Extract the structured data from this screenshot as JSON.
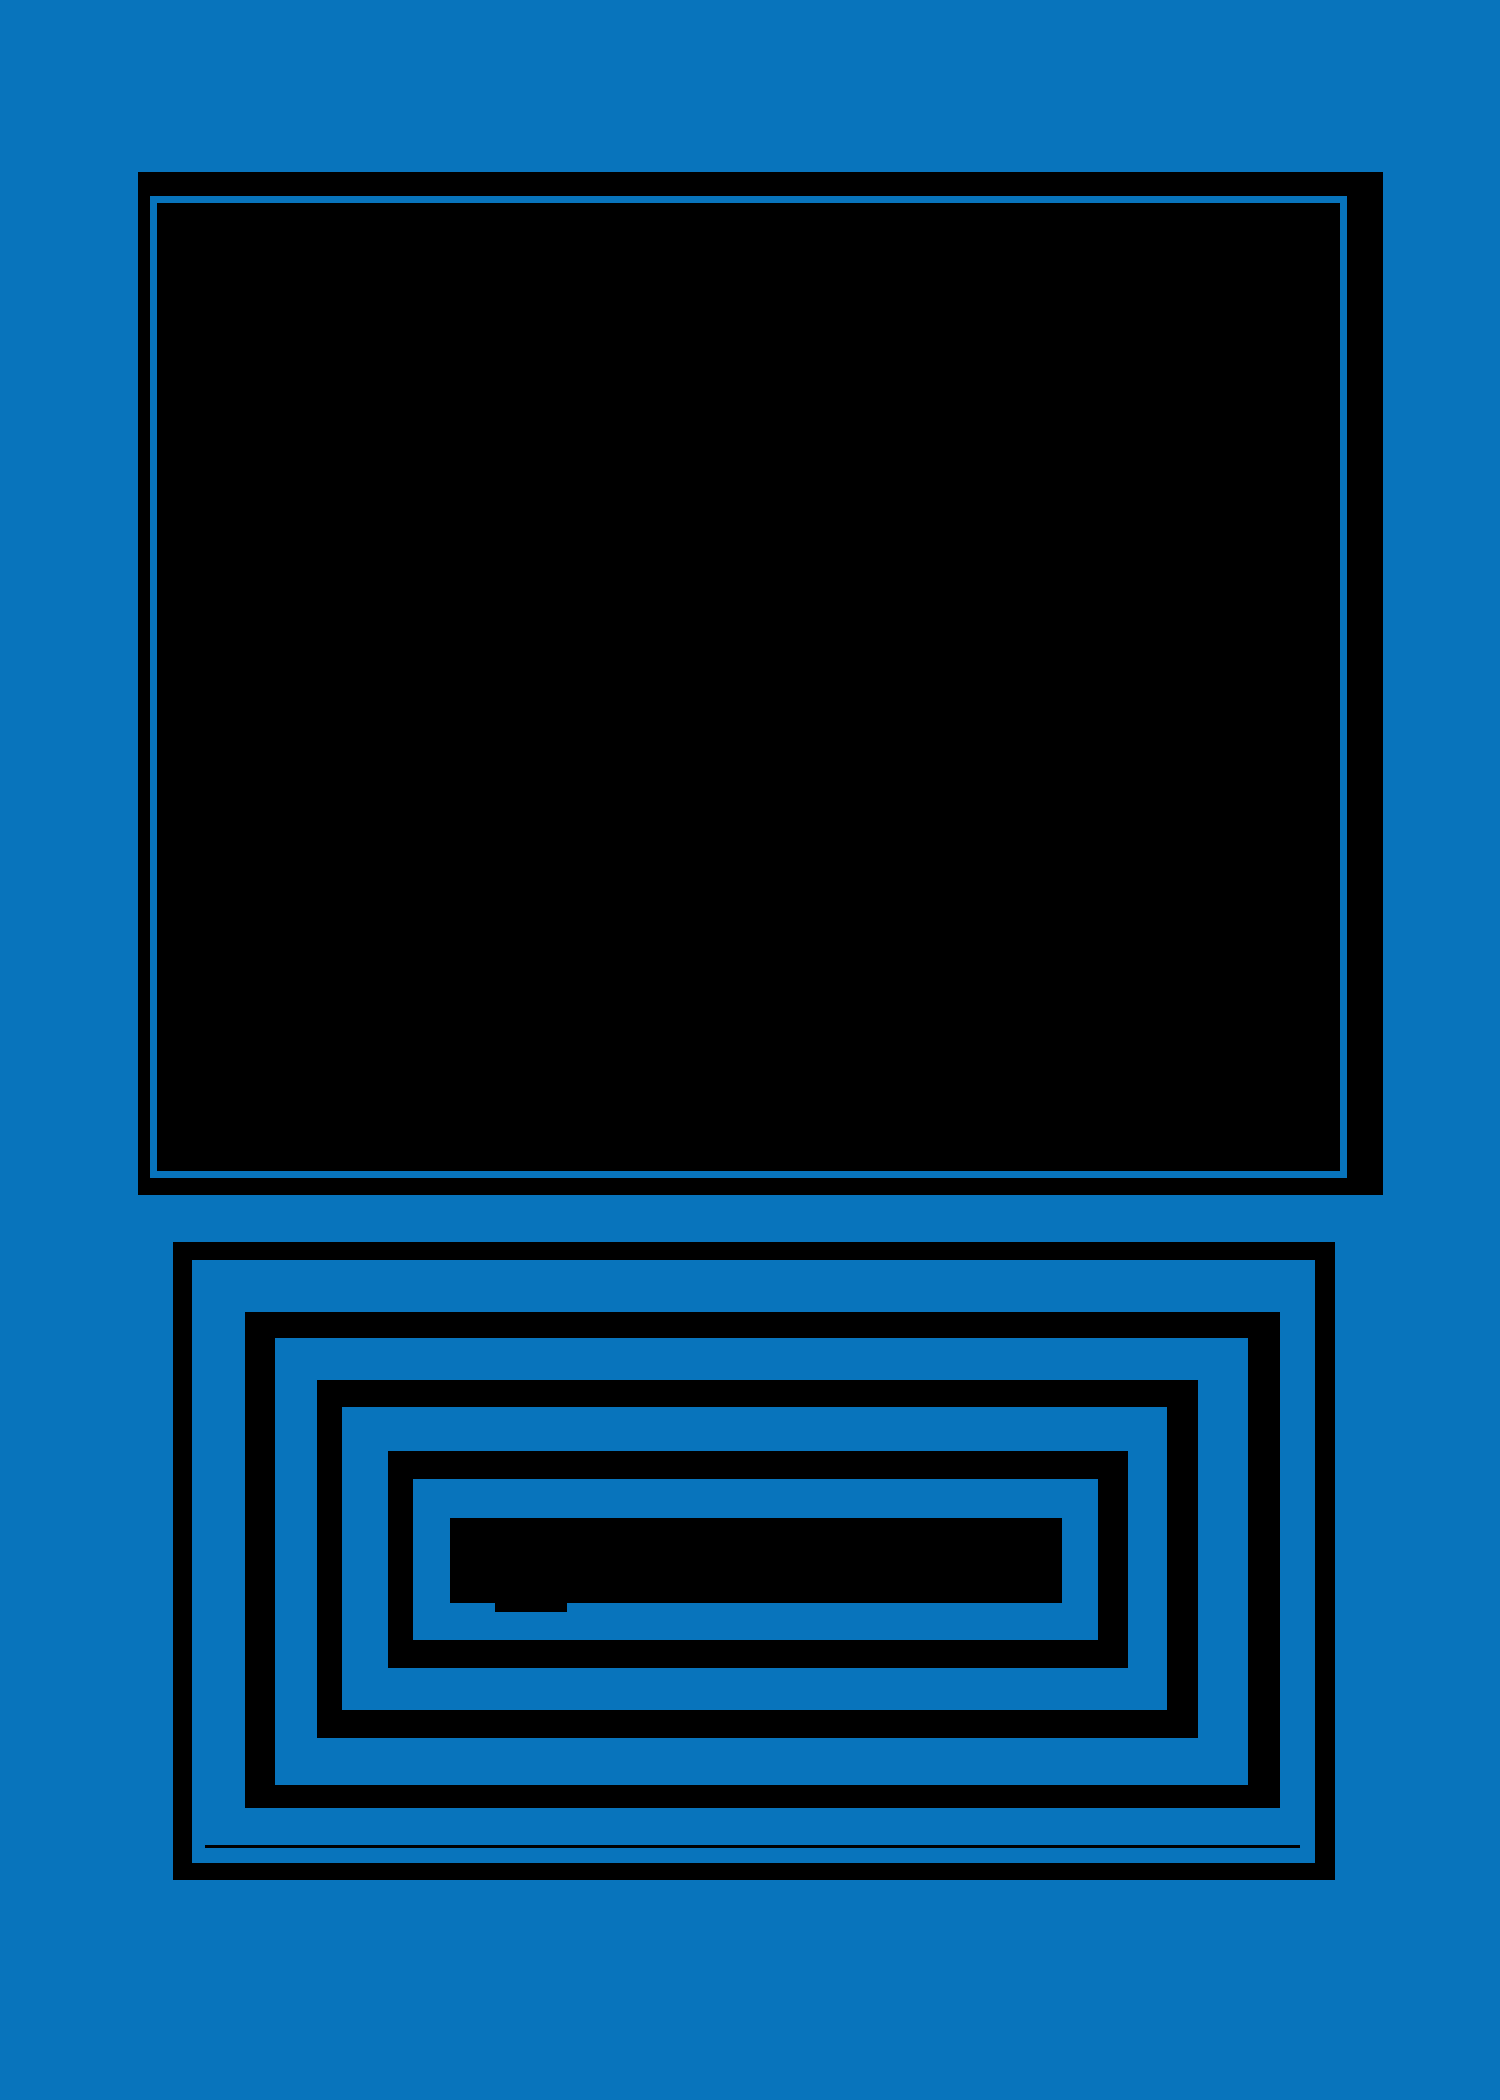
{
  "figure": {
    "description": "abstract-monitor-glyph",
    "text_content": ""
  },
  "colors": {
    "background": "#0874BC",
    "shape": "#000000",
    "accent_line": "#0874BC"
  },
  "shapes": {
    "monitor_frame": {
      "x": 138,
      "y": 172,
      "w": 1245,
      "h": 1023
    },
    "monitor_inner_line": {
      "x": 150,
      "y": 196,
      "w": 1197,
      "h": 982,
      "b": [
        7,
        7,
        7,
        7
      ]
    },
    "ring_a": {
      "x": 173,
      "y": 1242,
      "w": 1162,
      "h": 638,
      "b": [
        18,
        20,
        17,
        19
      ]
    },
    "ring_b": {
      "x": 245,
      "y": 1312,
      "w": 1035,
      "h": 496,
      "b": [
        26,
        32,
        23,
        30
      ]
    },
    "ring_c": {
      "x": 317,
      "y": 1380,
      "w": 881,
      "h": 358,
      "b": [
        27,
        31,
        28,
        25
      ]
    },
    "ring_d": {
      "x": 388,
      "y": 1451,
      "w": 740,
      "h": 217,
      "b": [
        28,
        30,
        28,
        25
      ]
    },
    "center_bar": {
      "x": 450,
      "y": 1518,
      "w": 612,
      "h": 85
    },
    "bar_notch": {
      "x": 495,
      "y": 1603,
      "w": 72,
      "h": 9
    },
    "bottom_accent_line": {
      "x": 205,
      "y": 1845,
      "w": 1095,
      "h": 3
    }
  }
}
